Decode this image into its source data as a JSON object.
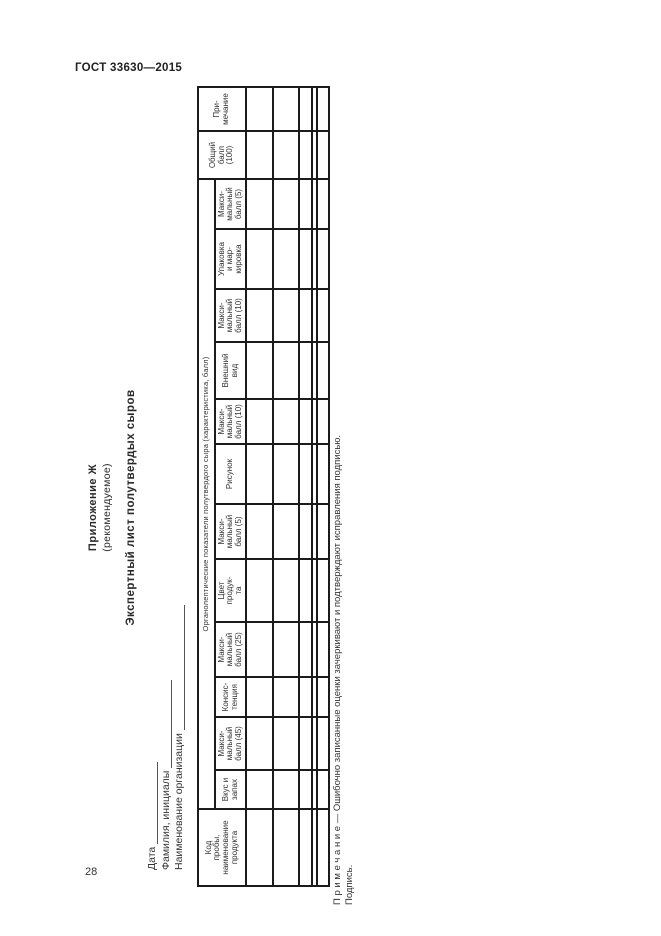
{
  "page": {
    "gost_header": "ГОСТ 33630—2015",
    "page_number": "28"
  },
  "appendix": {
    "label": "Приложение Ж",
    "type": "(рекомендуемое)",
    "title": "Экспертный лист полутвердых сыров"
  },
  "form": {
    "fields": [
      {
        "label": "Дата"
      },
      {
        "label": "Фамилия, инициалы"
      },
      {
        "label": "Наименование организации"
      }
    ]
  },
  "table": {
    "group_header": "Органолептические показатели полутвердого сыра (характеристика, балл)",
    "columns": [
      "Код\nпробы,\nнаименование\nпродукта",
      "Вкус и\nзапах",
      "Макси-\nмальный\nбалл (45)",
      "Консис-\nтенция",
      "Макси-\nмальный\nбалл (25)",
      "Цвет\nпродук-\nта",
      "Макси-\nмальный\nбалл (5)",
      "Рисунок",
      "Макси-\nмальный\nбалл (10)",
      "Внешний\nвид",
      "Макси-\nмальный\nбалл (10)",
      "Упаковка\nи мар-\nкировка",
      "Макси-\nмальный\nбалл (5)",
      "Общий\nбалл\n(100)",
      "При-\nмечание"
    ],
    "column_count": 15,
    "empty_row_heights": [
      27,
      26,
      13,
      5,
      12
    ]
  },
  "note": {
    "text": "П р и м е ч а н и е — Ошибочно записанные оценки зачеркивают и подтверждают исправления подписью.",
    "signature": "Подпись."
  }
}
